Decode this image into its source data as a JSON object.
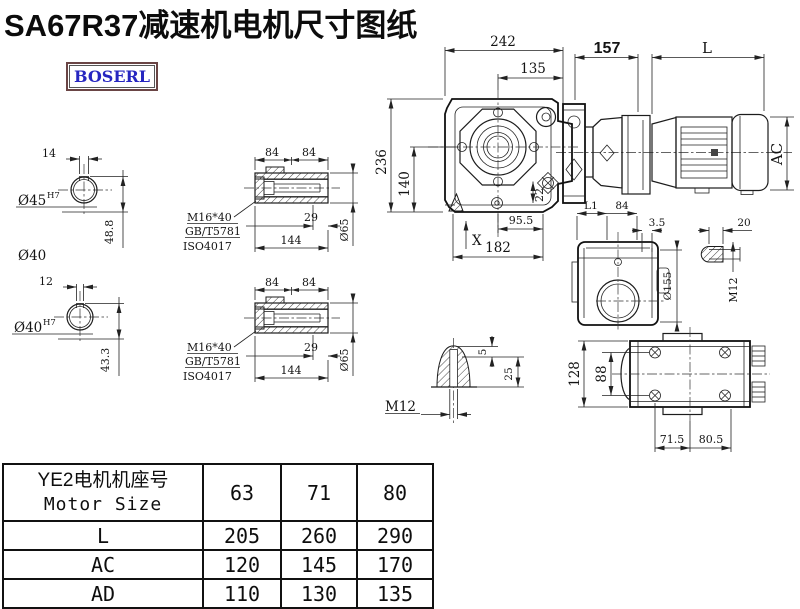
{
  "title": "SA67R37减速机电机尺寸图纸",
  "logo": "BOSERL",
  "colors": {
    "line": "#1c1c1c",
    "logo_text": "#2626c0",
    "logo_border": "#6a4545",
    "background": "#ffffff"
  },
  "dims": {
    "shaft1": {
      "key": "14",
      "bore": "Ø45",
      "fit": "H7",
      "height": "48.8",
      "od": "Ø40"
    },
    "shaft2": {
      "key": "12",
      "bore": "Ø40",
      "fit": "H7",
      "height": "43.3"
    },
    "bushing": {
      "a": "84",
      "b": "84",
      "l29": "29",
      "l144": "144",
      "dia": "Ø65",
      "thread": "M16*40",
      "std1": "GB/T5781",
      "std2": "ISO4017"
    },
    "front": {
      "w": "242",
      "wi": "135",
      "h": "236",
      "hc": "140",
      "k": "22",
      "b1": "95.5",
      "b2": "182",
      "x": "X"
    },
    "assembly": {
      "a": "157",
      "l": "L",
      "ac": "AC"
    },
    "input": {
      "l1": "L1",
      "w": "84",
      "t": "3.5",
      "dia": "Ø155",
      "slot": "20",
      "m12": "M12"
    },
    "dome": {
      "m12": "M12",
      "t5": "5",
      "t25": "25"
    },
    "top": {
      "h": "128",
      "hb": "88",
      "b1": "71.5",
      "b2": "80.5"
    }
  },
  "table": {
    "header_line1": "YE2电机机座号",
    "header_line2": "Motor Size",
    "col_headers": [
      "63",
      "71",
      "80"
    ],
    "rows": [
      {
        "label": "L",
        "values": [
          "205",
          "260",
          "290"
        ]
      },
      {
        "label": "AC",
        "values": [
          "120",
          "145",
          "170"
        ]
      },
      {
        "label": "AD",
        "values": [
          "110",
          "130",
          "135"
        ]
      }
    ]
  }
}
